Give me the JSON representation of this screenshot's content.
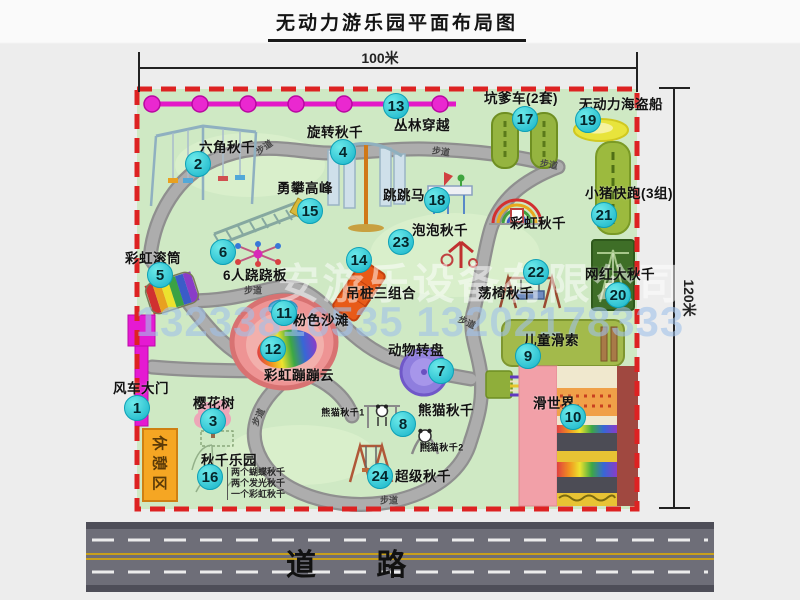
{
  "title": "无动力游乐园平面布局图",
  "dimensions": {
    "top": "100米",
    "right": "120米"
  },
  "road": {
    "label": "道 路"
  },
  "watermark": {
    "company": "安游乐设备有限公司",
    "phone": "13233816535 13202178333"
  },
  "rest_area": {
    "label": "休憩区"
  },
  "swing_park_notes": [
    "两个蝴蝶秋千",
    "两个发光秋千",
    "一个彩虹秋千"
  ],
  "markers": [
    {
      "num": 1,
      "x": 137,
      "y": 408
    },
    {
      "num": 2,
      "x": 198,
      "y": 164
    },
    {
      "num": 3,
      "x": 213,
      "y": 421
    },
    {
      "num": 4,
      "x": 343,
      "y": 152
    },
    {
      "num": 5,
      "x": 160,
      "y": 275
    },
    {
      "num": 6,
      "x": 223,
      "y": 252
    },
    {
      "num": 7,
      "x": 441,
      "y": 371
    },
    {
      "num": 8,
      "x": 403,
      "y": 424
    },
    {
      "num": 9,
      "x": 528,
      "y": 356
    },
    {
      "num": 10,
      "x": 573,
      "y": 417
    },
    {
      "num": 11,
      "x": 284,
      "y": 313
    },
    {
      "num": 12,
      "x": 273,
      "y": 349
    },
    {
      "num": 13,
      "x": 396,
      "y": 106
    },
    {
      "num": 14,
      "x": 359,
      "y": 260
    },
    {
      "num": 15,
      "x": 310,
      "y": 211
    },
    {
      "num": 16,
      "x": 210,
      "y": 477
    },
    {
      "num": 17,
      "x": 525,
      "y": 119
    },
    {
      "num": 18,
      "x": 437,
      "y": 200
    },
    {
      "num": 19,
      "x": 588,
      "y": 120
    },
    {
      "num": 20,
      "x": 618,
      "y": 295
    },
    {
      "num": 21,
      "x": 604,
      "y": 215
    },
    {
      "num": 22,
      "x": 536,
      "y": 272
    },
    {
      "num": 23,
      "x": 401,
      "y": 242
    },
    {
      "num": 24,
      "x": 380,
      "y": 476
    }
  ],
  "labels": [
    {
      "text": "六角秋千",
      "x": 227,
      "y": 146
    },
    {
      "text": "旋转秋千",
      "x": 335,
      "y": 131
    },
    {
      "text": "丛林穿越",
      "x": 422,
      "y": 124
    },
    {
      "text": "坑爹车(2套)",
      "x": 521,
      "y": 97
    },
    {
      "text": "无动力海盗船",
      "x": 621,
      "y": 103
    },
    {
      "text": "勇攀高峰",
      "x": 305,
      "y": 187
    },
    {
      "text": "跳跳马",
      "x": 404,
      "y": 194
    },
    {
      "text": "小猪快跑(3组)",
      "x": 629,
      "y": 192
    },
    {
      "text": "泡泡秋千",
      "x": 440,
      "y": 229
    },
    {
      "text": "彩虹秋千",
      "x": 538,
      "y": 222
    },
    {
      "text": "彩虹滚筒",
      "x": 153,
      "y": 257
    },
    {
      "text": "6人跷跷板",
      "x": 255,
      "y": 274
    },
    {
      "text": "吊桩三组合",
      "x": 381,
      "y": 292
    },
    {
      "text": "荡椅秋千",
      "x": 506,
      "y": 292
    },
    {
      "text": "网红大秋千",
      "x": 620,
      "y": 273
    },
    {
      "text": "粉色沙滩",
      "x": 321,
      "y": 319
    },
    {
      "text": "彩虹蹦蹦云",
      "x": 299,
      "y": 374
    },
    {
      "text": "动物转盘",
      "x": 416,
      "y": 349
    },
    {
      "text": "儿童滑索",
      "x": 551,
      "y": 339
    },
    {
      "text": "滑世界",
      "x": 554,
      "y": 402
    },
    {
      "text": "熊猫秋千",
      "x": 446,
      "y": 409
    },
    {
      "text": "熊猫秋千1",
      "x": 343,
      "y": 412,
      "size": 9
    },
    {
      "text": "熊猫秋千2",
      "x": 442,
      "y": 447,
      "size": 9
    },
    {
      "text": "风车大门",
      "x": 141,
      "y": 387
    },
    {
      "text": "樱花树",
      "x": 214,
      "y": 402
    },
    {
      "text": "秋千乐园",
      "x": 229,
      "y": 459
    },
    {
      "text": "超级秋千",
      "x": 423,
      "y": 475
    }
  ],
  "path_labels": [
    {
      "text": "步道",
      "x": 264,
      "y": 147,
      "rot": -35
    },
    {
      "text": "步道",
      "x": 441,
      "y": 151,
      "rot": 8
    },
    {
      "text": "步道",
      "x": 549,
      "y": 164,
      "rot": 10
    },
    {
      "text": "步道",
      "x": 253,
      "y": 290,
      "rot": 0
    },
    {
      "text": "步道",
      "x": 467,
      "y": 322,
      "rot": 25
    },
    {
      "text": "步道",
      "x": 258,
      "y": 417,
      "rot": -65
    },
    {
      "text": "步道",
      "x": 389,
      "y": 500,
      "rot": 0
    }
  ],
  "icons": [
    "windmill-gate-icon",
    "hex-swing-icon",
    "rotary-swing-icon",
    "jungle-crossing-fence-icon",
    "climbing-peak-icon",
    "kart-track-icon",
    "pirate-ship-icon",
    "pig-run-track-icon",
    "rainbow-swing-icon",
    "big-swing-icon",
    "bench-swing-icon",
    "jump-horse-icon",
    "bubble-swing-icon",
    "hanging-posts-icon",
    "seesaw-icon",
    "rainbow-roller-icon",
    "bounce-cloud-icon",
    "animal-turntable-icon",
    "zipline-platform-icon",
    "zipline-cables-icon",
    "slide-world-icon",
    "panda-swing-1-icon",
    "panda-swing-2-icon",
    "super-swing-icon",
    "cherry-tree-icon",
    "swing-park-icon"
  ],
  "colors": {
    "park_green": "#cfe9c4",
    "path_gray": "#ababab",
    "border_red": "#dd2222",
    "fence_magenta": "#e318c8",
    "marker_cyan": "#2fd0da",
    "rest_orange": "#f5a623",
    "road_gray": "#6e6e78",
    "road_yellow": "#c8a01c"
  }
}
